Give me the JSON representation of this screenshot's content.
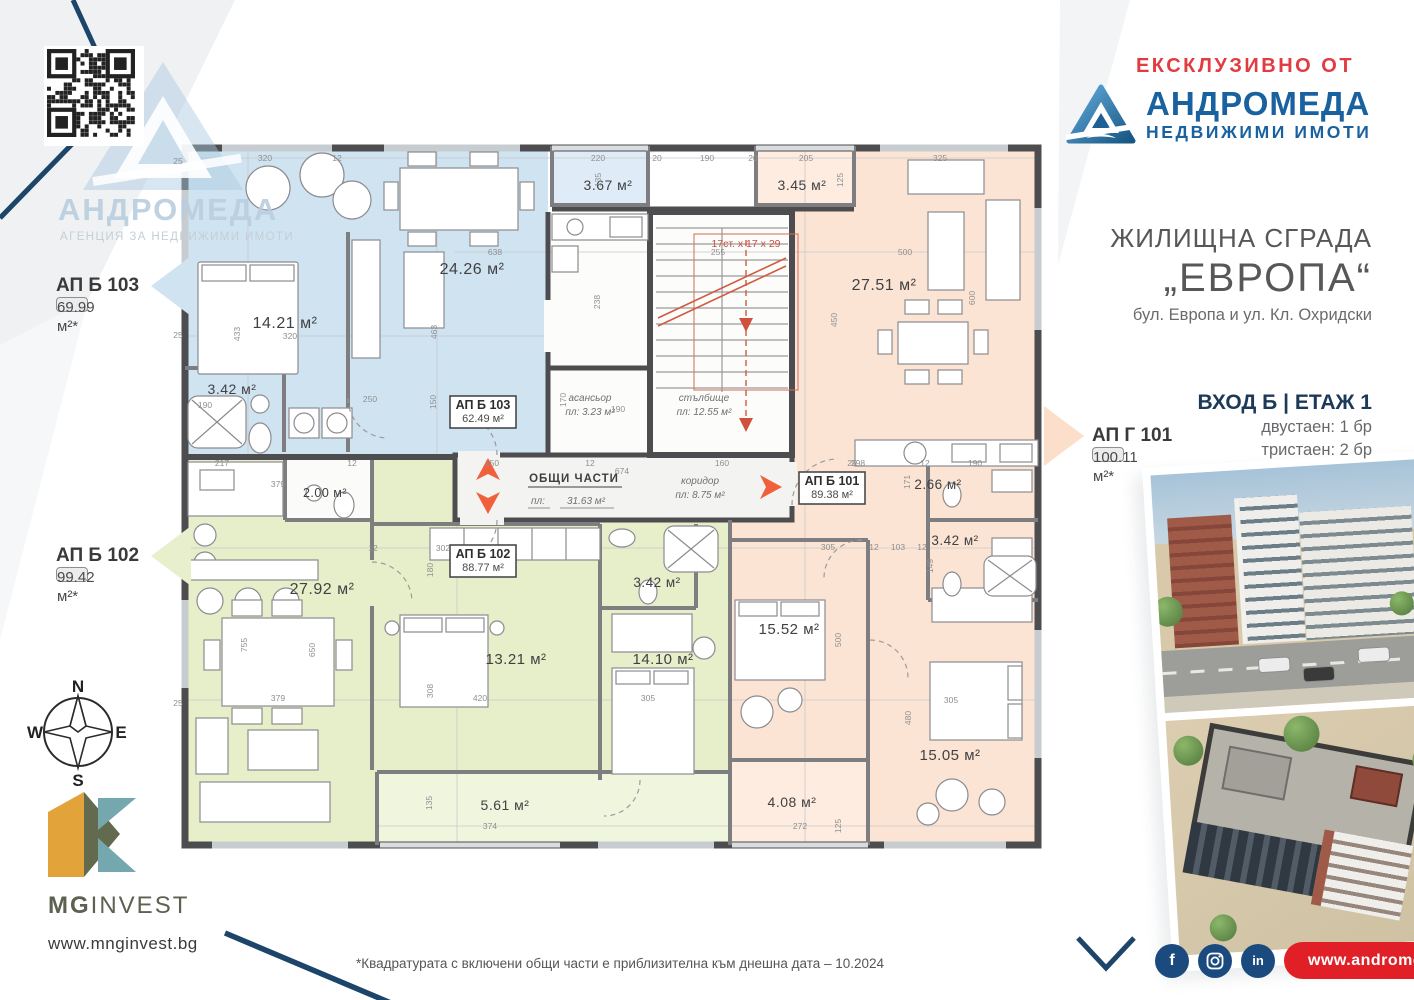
{
  "colors": {
    "accent_red": "#E23B41",
    "brand_blue": "#1A61A0",
    "dark_navy": "#1C3A57",
    "pill_red": "#E01F26",
    "apt_blue": "#cfe3f1",
    "apt_green": "#e6efc9",
    "apt_pink": "#fbe4d3"
  },
  "branding": {
    "exclusive_label": "ЕКСКЛУЗИВНО ОТ",
    "agency_name": "АНДРОМЕДА",
    "agency_tagline": "НЕДВИЖИМИ ИМОТИ",
    "watermark_name": "АНДРОМЕДА",
    "watermark_tagline": "АГЕНЦИЯ ЗА НЕДВИЖИМИ ИМОТИ"
  },
  "project": {
    "type_label": "ЖИЛИЩНА СГРАДА",
    "name": "„ЕВРОПА“",
    "address": "бул. Европа и ул. Кл. Охридски",
    "entrance": "ВХОД Б | ЕТАЖ 1",
    "mix": [
      "двустаен: 1 бр",
      "тристаен: 2 бр"
    ]
  },
  "callouts": [
    {
      "id": "АП Б 103",
      "area": "69.99 м²*"
    },
    {
      "id": "АП Б 102",
      "area": "99.42 м²*"
    },
    {
      "id": "АП Г 101",
      "area": "100.11 м²*"
    }
  ],
  "plan": {
    "unit_boxes": [
      {
        "id": "АП Б 103",
        "area": "62.49 м²"
      },
      {
        "id": "АП Б 102",
        "area": "88.77 м²"
      },
      {
        "id": "АП Б 101",
        "area": "89.38 м²"
      }
    ],
    "common": {
      "title": "ОБЩИ ЧАСТИ",
      "area_label": "пл:",
      "area_value": "31.63 м²",
      "corridor": "коридор",
      "corridor_area": "пл: 8.75 м²",
      "elevator": "асансьор",
      "elevator_area": "пл: 3.23 м²",
      "stairs": "стълбище",
      "stairs_area": "пл: 12.55 м²",
      "stairs_note": "17ст. х 17 х 29"
    },
    "room_labels": [
      {
        "t": "14.21 м²",
        "x": 285,
        "y": 328,
        "s": 16
      },
      {
        "t": "24.26 м²",
        "x": 472,
        "y": 274,
        "s": 16
      },
      {
        "t": "3.42 м²",
        "x": 232,
        "y": 394,
        "s": 14
      },
      {
        "t": "3.67 м²",
        "x": 608,
        "y": 190,
        "s": 14
      },
      {
        "t": "3.45 м²",
        "x": 802,
        "y": 190,
        "s": 14
      },
      {
        "t": "27.51 м²",
        "x": 884,
        "y": 290,
        "s": 16
      },
      {
        "t": "2.66 м²",
        "x": 938,
        "y": 489,
        "s": 13.5
      },
      {
        "t": "3.42 м²",
        "x": 955,
        "y": 545,
        "s": 13.5
      },
      {
        "t": "15.52 м²",
        "x": 789,
        "y": 634,
        "s": 15
      },
      {
        "t": "15.05 м²",
        "x": 950,
        "y": 760,
        "s": 15
      },
      {
        "t": "4.08 м²",
        "x": 792,
        "y": 807,
        "s": 14
      },
      {
        "t": "27.92 м²",
        "x": 322,
        "y": 594,
        "s": 16
      },
      {
        "t": "2.00 м²",
        "x": 325,
        "y": 497,
        "s": 12.5
      },
      {
        "t": "13.21 м²",
        "x": 516,
        "y": 664,
        "s": 15
      },
      {
        "t": "14.10 м²",
        "x": 663,
        "y": 664,
        "s": 15
      },
      {
        "t": "3.42 м²",
        "x": 657,
        "y": 587,
        "s": 13.5
      },
      {
        "t": "5.61 м²",
        "x": 505,
        "y": 810,
        "s": 14
      }
    ],
    "dims": [
      {
        "t": "320",
        "x": 265,
        "y": 161
      },
      {
        "t": "12",
        "x": 337,
        "y": 161
      },
      {
        "t": "220",
        "x": 598,
        "y": 161
      },
      {
        "t": "20",
        "x": 657,
        "y": 161
      },
      {
        "t": "190",
        "x": 707,
        "y": 161
      },
      {
        "t": "20",
        "x": 753,
        "y": 161
      },
      {
        "t": "205",
        "x": 806,
        "y": 161
      },
      {
        "t": "325",
        "x": 940,
        "y": 161
      },
      {
        "t": "135",
        "x": 601,
        "y": 180,
        "r": 1
      },
      {
        "t": "125",
        "x": 843,
        "y": 180,
        "r": 1
      },
      {
        "t": "638",
        "x": 495,
        "y": 255
      },
      {
        "t": "255",
        "x": 718,
        "y": 255
      },
      {
        "t": "500",
        "x": 905,
        "y": 255
      },
      {
        "t": "433",
        "x": 240,
        "y": 334,
        "r": 1
      },
      {
        "t": "320",
        "x": 290,
        "y": 339
      },
      {
        "t": "463",
        "x": 437,
        "y": 332,
        "r": 1
      },
      {
        "t": "238",
        "x": 600,
        "y": 302,
        "r": 1
      },
      {
        "t": "450",
        "x": 837,
        "y": 320,
        "r": 1
      },
      {
        "t": "600",
        "x": 975,
        "y": 298,
        "r": 1
      },
      {
        "t": "190",
        "x": 205,
        "y": 408
      },
      {
        "t": "250",
        "x": 370,
        "y": 402
      },
      {
        "t": "150",
        "x": 436,
        "y": 402,
        "r": 1
      },
      {
        "t": "217",
        "x": 222,
        "y": 466
      },
      {
        "t": "12",
        "x": 352,
        "y": 466
      },
      {
        "t": "150",
        "x": 492,
        "y": 466
      },
      {
        "t": "12",
        "x": 590,
        "y": 466
      },
      {
        "t": "160",
        "x": 722,
        "y": 466
      },
      {
        "t": "674",
        "x": 622,
        "y": 474
      },
      {
        "t": "190",
        "x": 618,
        "y": 412
      },
      {
        "t": "170",
        "x": 566,
        "y": 400,
        "r": 1
      },
      {
        "t": "379",
        "x": 278,
        "y": 487
      },
      {
        "t": "302",
        "x": 443,
        "y": 551
      },
      {
        "t": "12",
        "x": 373,
        "y": 551
      },
      {
        "t": "180",
        "x": 433,
        "y": 570,
        "r": 1
      },
      {
        "t": "650",
        "x": 315,
        "y": 650,
        "r": 1
      },
      {
        "t": "755",
        "x": 247,
        "y": 645,
        "r": 1
      },
      {
        "t": "379",
        "x": 278,
        "y": 701
      },
      {
        "t": "308",
        "x": 433,
        "y": 691,
        "r": 1
      },
      {
        "t": "420",
        "x": 480,
        "y": 701
      },
      {
        "t": "305",
        "x": 648,
        "y": 701
      },
      {
        "t": "305",
        "x": 828,
        "y": 550
      },
      {
        "t": "12",
        "x": 874,
        "y": 550
      },
      {
        "t": "103",
        "x": 898,
        "y": 550
      },
      {
        "t": "12",
        "x": 922,
        "y": 550
      },
      {
        "t": "149",
        "x": 933,
        "y": 566,
        "r": 1
      },
      {
        "t": "190",
        "x": 975,
        "y": 466
      },
      {
        "t": "298",
        "x": 858,
        "y": 466
      },
      {
        "t": "12",
        "x": 925,
        "y": 466
      },
      {
        "t": "171",
        "x": 910,
        "y": 482,
        "r": 1
      },
      {
        "t": "500",
        "x": 841,
        "y": 640,
        "r": 1
      },
      {
        "t": "480",
        "x": 911,
        "y": 718,
        "r": 1
      },
      {
        "t": "305",
        "x": 951,
        "y": 703
      },
      {
        "t": "135",
        "x": 432,
        "y": 803,
        "r": 1
      },
      {
        "t": "374",
        "x": 490,
        "y": 829
      },
      {
        "t": "272",
        "x": 800,
        "y": 829
      },
      {
        "t": "125",
        "x": 841,
        "y": 826,
        "r": 1
      },
      {
        "t": "25",
        "x": 178,
        "y": 164
      },
      {
        "t": "25",
        "x": 178,
        "y": 338
      },
      {
        "t": "25",
        "x": 178,
        "y": 554
      },
      {
        "t": "25",
        "x": 178,
        "y": 706
      },
      {
        "t": "25",
        "x": 852,
        "y": 466
      }
    ]
  },
  "compass": {
    "n": "N",
    "e": "E",
    "s": "S",
    "w": "W"
  },
  "developer": {
    "name_bold": "MG",
    "name_light": "INVEST",
    "website": "www.mnginvest.bg"
  },
  "social": {
    "facebook": "f",
    "linkedin": "in"
  },
  "footer": {
    "disclaimer": "*Квадратурата с включени общи части е приблизителна към днешна дата – 10.2024",
    "agency_website": "www.andromeda.bg"
  }
}
